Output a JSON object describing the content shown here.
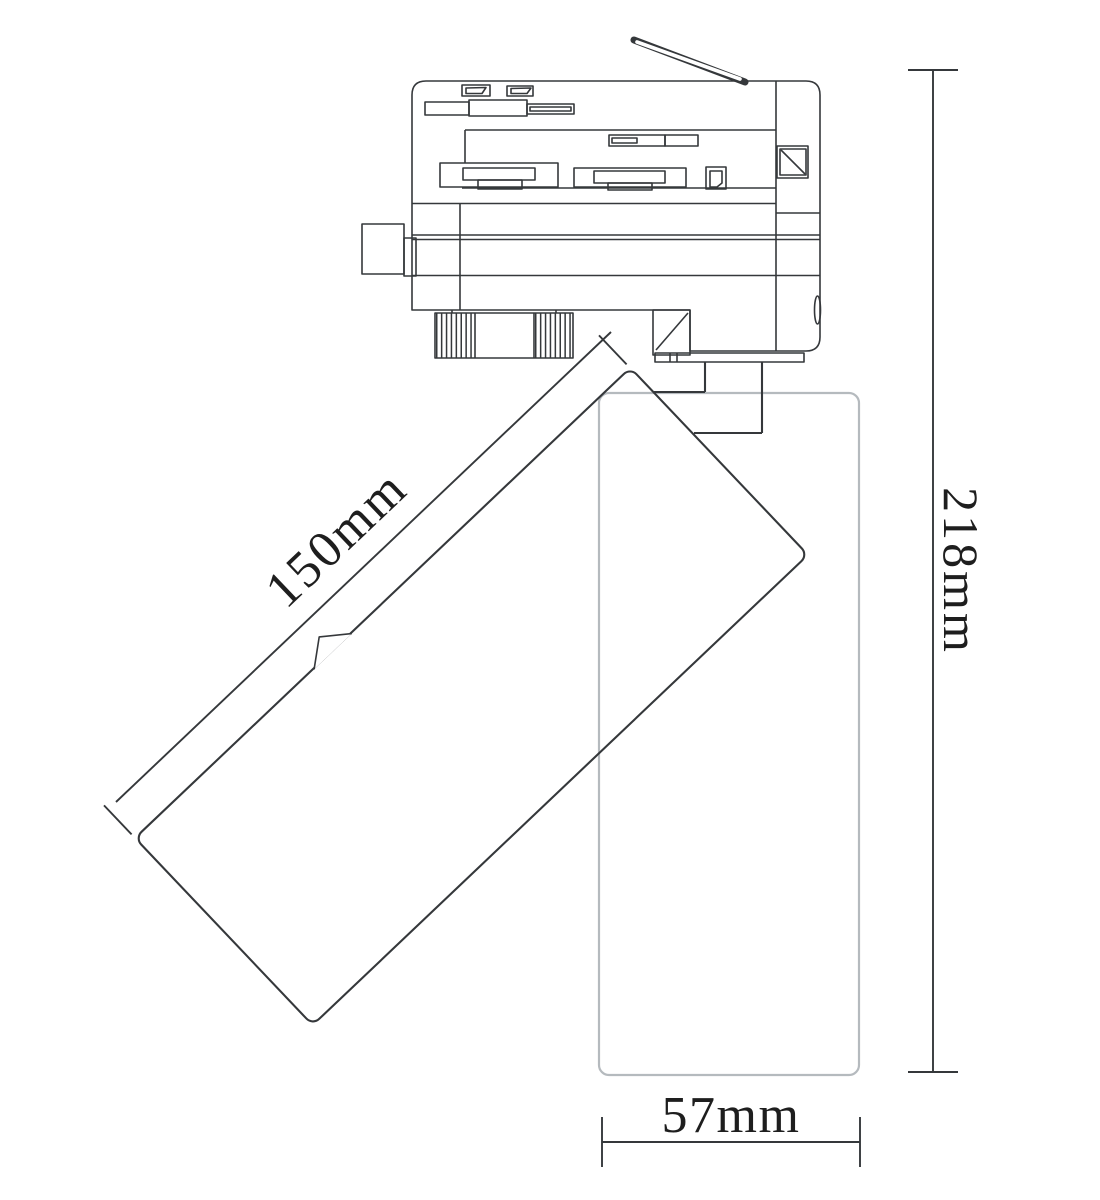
{
  "dimensions": {
    "length_label": "150mm",
    "height_label": "218mm",
    "width_label": "57mm"
  },
  "colors": {
    "line": "#35383b",
    "ghost": "#b5babe",
    "text": "#1e1e1e",
    "background": "#ffffff"
  }
}
